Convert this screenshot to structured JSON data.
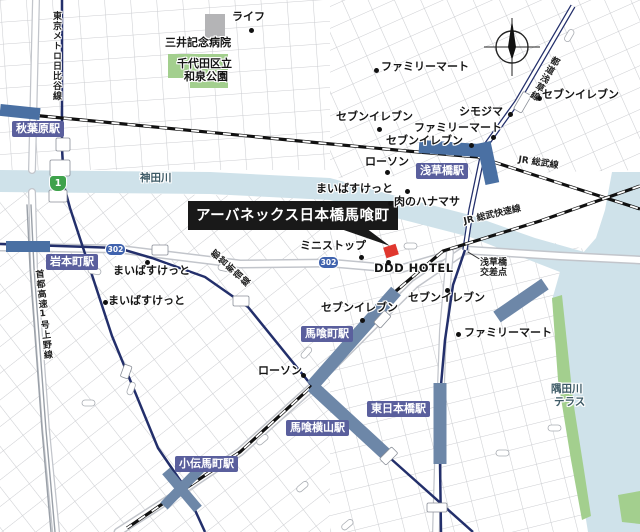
{
  "map": {
    "callout": {
      "text": "アーバネックス日本橋馬喰町",
      "x": 188,
      "y": 201
    },
    "stations": [
      {
        "t": "秋葉原駅",
        "x": 12,
        "y": 121
      },
      {
        "t": "岩本町駅",
        "x": 46,
        "y": 254
      },
      {
        "t": "浅草橋駅",
        "x": 416,
        "y": 163
      },
      {
        "t": "馬喰町駅",
        "x": 301,
        "y": 326
      },
      {
        "t": "東日本橋駅",
        "x": 367,
        "y": 401
      },
      {
        "t": "馬喰横山駅",
        "x": 286,
        "y": 420
      },
      {
        "t": "小伝馬町駅",
        "x": 175,
        "y": 456
      }
    ],
    "captions": [
      {
        "t": "ライフ",
        "x": 232,
        "y": 11,
        "c": "poi"
      },
      {
        "t": "三井記念病院",
        "x": 165,
        "y": 37,
        "c": "poi"
      },
      {
        "t": "千代田区立",
        "x": 177,
        "y": 58,
        "c": "poi"
      },
      {
        "t": "和泉公園",
        "x": 184,
        "y": 71,
        "c": "poi"
      },
      {
        "t": "ファミリーマート",
        "x": 381,
        "y": 61,
        "c": "poi"
      },
      {
        "t": "セブンイレブン",
        "x": 542,
        "y": 89,
        "c": "poi"
      },
      {
        "t": "シモジマ",
        "x": 459,
        "y": 106,
        "c": "poi"
      },
      {
        "t": "ファミリーマート",
        "x": 414,
        "y": 122,
        "c": "poi"
      },
      {
        "t": "セブンイレブン",
        "x": 386,
        "y": 135,
        "c": "poi"
      },
      {
        "t": "セブンイレブン",
        "x": 336,
        "y": 111,
        "c": "poi"
      },
      {
        "t": "ローソン",
        "x": 365,
        "y": 156,
        "c": "poi"
      },
      {
        "t": "まいばすけっと",
        "x": 316,
        "y": 183,
        "c": "poi"
      },
      {
        "t": "肉のハナマサ",
        "x": 394,
        "y": 196,
        "c": "poi"
      },
      {
        "t": "まいばすけっと",
        "x": 113,
        "y": 265,
        "c": "poi"
      },
      {
        "t": "まいばすけっと",
        "x": 108,
        "y": 295,
        "c": "poi"
      },
      {
        "t": "ミニストップ",
        "x": 300,
        "y": 240,
        "c": "poi"
      },
      {
        "t": "セブンイレブン",
        "x": 321,
        "y": 302,
        "c": "poi"
      },
      {
        "t": "セブンイレブン",
        "x": 408,
        "y": 292,
        "c": "poi"
      },
      {
        "t": "ファミリーマート",
        "x": 464,
        "y": 327,
        "c": "poi"
      },
      {
        "t": "ローソン",
        "x": 258,
        "y": 365,
        "c": "poi"
      },
      {
        "t": "神田川",
        "x": 140,
        "y": 173,
        "c": "water"
      },
      {
        "t": "隅田川",
        "x": 551,
        "y": 384,
        "c": "water"
      },
      {
        "t": "テラス",
        "x": 554,
        "y": 397,
        "c": "water"
      },
      {
        "t": "JR 総武線",
        "x": 519,
        "y": 156,
        "c": "roadlbl",
        "r": 9
      },
      {
        "t": "JR 総武快速線",
        "x": 463,
        "y": 218,
        "c": "roadlbl",
        "r": -13
      },
      {
        "t": "東京メトロ日比谷線",
        "x": 51,
        "y": 11,
        "c": "vroad"
      },
      {
        "t": "首都高速1号上野線",
        "x": 33,
        "y": 270,
        "c": "vroad",
        "r": -6
      },
      {
        "t": "都営新宿線",
        "x": 208,
        "y": 256,
        "c": "vroad",
        "r": -48
      },
      {
        "t": "都道浅草線",
        "x": 552,
        "y": 54,
        "c": "vroad",
        "r": 30
      },
      {
        "t": "浅草橋",
        "x": 480,
        "y": 259,
        "c": "xing"
      },
      {
        "t": "交差点",
        "x": 480,
        "y": 269,
        "c": "xing"
      },
      {
        "t": "DDD HOTEL",
        "x": 374,
        "y": 263,
        "c": "poi ddd"
      }
    ],
    "dots": [
      {
        "x": 251,
        "y": 30
      },
      {
        "x": 376,
        "y": 70
      },
      {
        "x": 539,
        "y": 98
      },
      {
        "x": 510,
        "y": 114
      },
      {
        "x": 493,
        "y": 137
      },
      {
        "x": 471,
        "y": 145
      },
      {
        "x": 379,
        "y": 129
      },
      {
        "x": 387,
        "y": 172
      },
      {
        "x": 407,
        "y": 191
      },
      {
        "x": 390,
        "y": 203
      },
      {
        "x": 147,
        "y": 262
      },
      {
        "x": 105,
        "y": 302
      },
      {
        "x": 361,
        "y": 257
      },
      {
        "x": 388,
        "y": 262
      },
      {
        "x": 362,
        "y": 320
      },
      {
        "x": 447,
        "y": 290
      },
      {
        "x": 458,
        "y": 334
      },
      {
        "x": 303,
        "y": 375
      }
    ],
    "shields": [
      {
        "t": "1",
        "x": 49,
        "y": 175,
        "c": "sh1"
      },
      {
        "t": "302",
        "x": 105,
        "y": 243,
        "c": "sh302"
      },
      {
        "t": "302",
        "x": 318,
        "y": 256,
        "c": "sh302"
      }
    ],
    "colors": {
      "water": "#cfe2ea",
      "park": "#a3cf8e",
      "station_band": "#6d87a8",
      "platform": "#4a70a3",
      "subway_line": "#232f6b",
      "station_label_bg": "#5a5f9d",
      "target_marker": "#e0372e",
      "callout_bg": "#191919",
      "shield_green": "#3fa24c",
      "shield_blue": "#4063ae",
      "grid": "#cccdd1"
    }
  }
}
